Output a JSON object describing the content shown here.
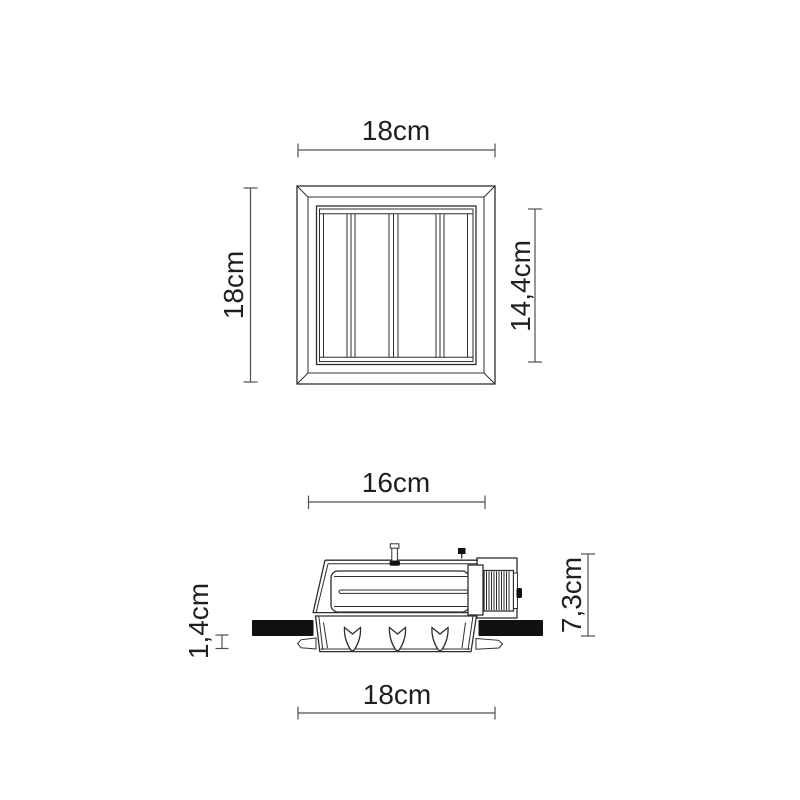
{
  "drawing": {
    "top_view": {
      "width_label": "18cm",
      "height_label": "18cm",
      "inner_height_label": "14,4cm"
    },
    "side_view": {
      "top_width_label": "16cm",
      "height_label": "7,3cm",
      "ceiling_thickness_label": "1,4cm",
      "bottom_width_label": "18cm"
    },
    "colors": {
      "background": "#ffffff",
      "line": "#2e2e2e",
      "dimension_line": "#4f4f4f",
      "text": "#1f1f1f",
      "ceiling_fill": "#111111"
    }
  }
}
